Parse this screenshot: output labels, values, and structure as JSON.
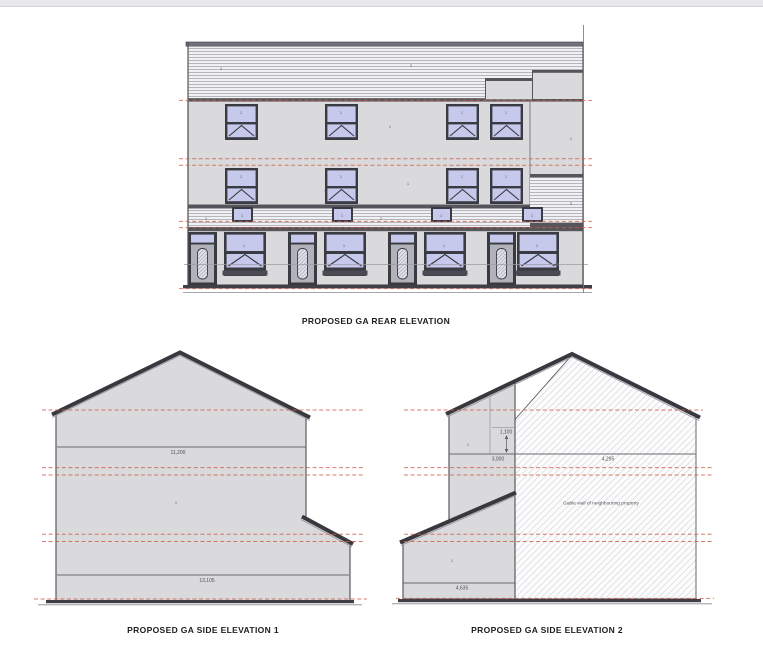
{
  "sheet": {
    "background": "#ffffff",
    "top_strip_color": "#e8e8ea"
  },
  "colors": {
    "wall": "#dadadd",
    "window_pane": "#c7c9ec",
    "frame": "#3a3a42",
    "red_datum": "#cd5a49",
    "ground": "#3f3f45",
    "mid_line": "#55555b"
  },
  "drawings": {
    "rear": {
      "title": "PROPOSED GA REAR ELEVATION"
    },
    "side1": {
      "title": "PROPOSED GA SIDE ELEVATION 1",
      "dim_upper": "11,200",
      "dim_lower": "13,105"
    },
    "side2": {
      "title": "PROPOSED GA SIDE ELEVATION 2",
      "dim_small": "1,100",
      "dim_left": "3,000",
      "dim_right": "4,295",
      "dim_bottom": "4,635",
      "note": "Gable wall of neighbouring property"
    }
  },
  "annotations": [
    {
      "x": 221,
      "y": 70,
      "t": "3"
    },
    {
      "x": 411,
      "y": 67,
      "t": "3"
    },
    {
      "x": 241,
      "y": 114,
      "t": "1"
    },
    {
      "x": 341,
      "y": 114,
      "t": "1"
    },
    {
      "x": 462,
      "y": 114,
      "t": "1"
    },
    {
      "x": 506,
      "y": 114,
      "t": "1"
    },
    {
      "x": 390,
      "y": 128,
      "t": "1"
    },
    {
      "x": 571,
      "y": 140,
      "t": "1"
    },
    {
      "x": 241,
      "y": 178,
      "t": "1"
    },
    {
      "x": 341,
      "y": 178,
      "t": "1"
    },
    {
      "x": 462,
      "y": 178,
      "t": "1"
    },
    {
      "x": 506,
      "y": 178,
      "t": "1"
    },
    {
      "x": 325,
      "y": 192,
      "t": "1"
    },
    {
      "x": 408,
      "y": 185,
      "t": "1"
    },
    {
      "x": 571,
      "y": 205,
      "t": "3"
    },
    {
      "x": 206,
      "y": 220,
      "t": "2"
    },
    {
      "x": 381,
      "y": 220,
      "t": "2"
    },
    {
      "x": 242,
      "y": 217,
      "t": "1"
    },
    {
      "x": 342,
      "y": 217,
      "t": "1"
    },
    {
      "x": 441,
      "y": 217,
      "t": "1"
    },
    {
      "x": 532,
      "y": 217,
      "t": "1"
    },
    {
      "x": 244,
      "y": 247,
      "t": "1"
    },
    {
      "x": 344,
      "y": 247,
      "t": "1"
    },
    {
      "x": 444,
      "y": 247,
      "t": "1"
    },
    {
      "x": 537,
      "y": 247,
      "t": "1"
    },
    {
      "x": 176,
      "y": 504,
      "t": "1"
    },
    {
      "x": 468,
      "y": 446,
      "t": "1"
    },
    {
      "x": 452,
      "y": 562,
      "t": "1"
    }
  ]
}
